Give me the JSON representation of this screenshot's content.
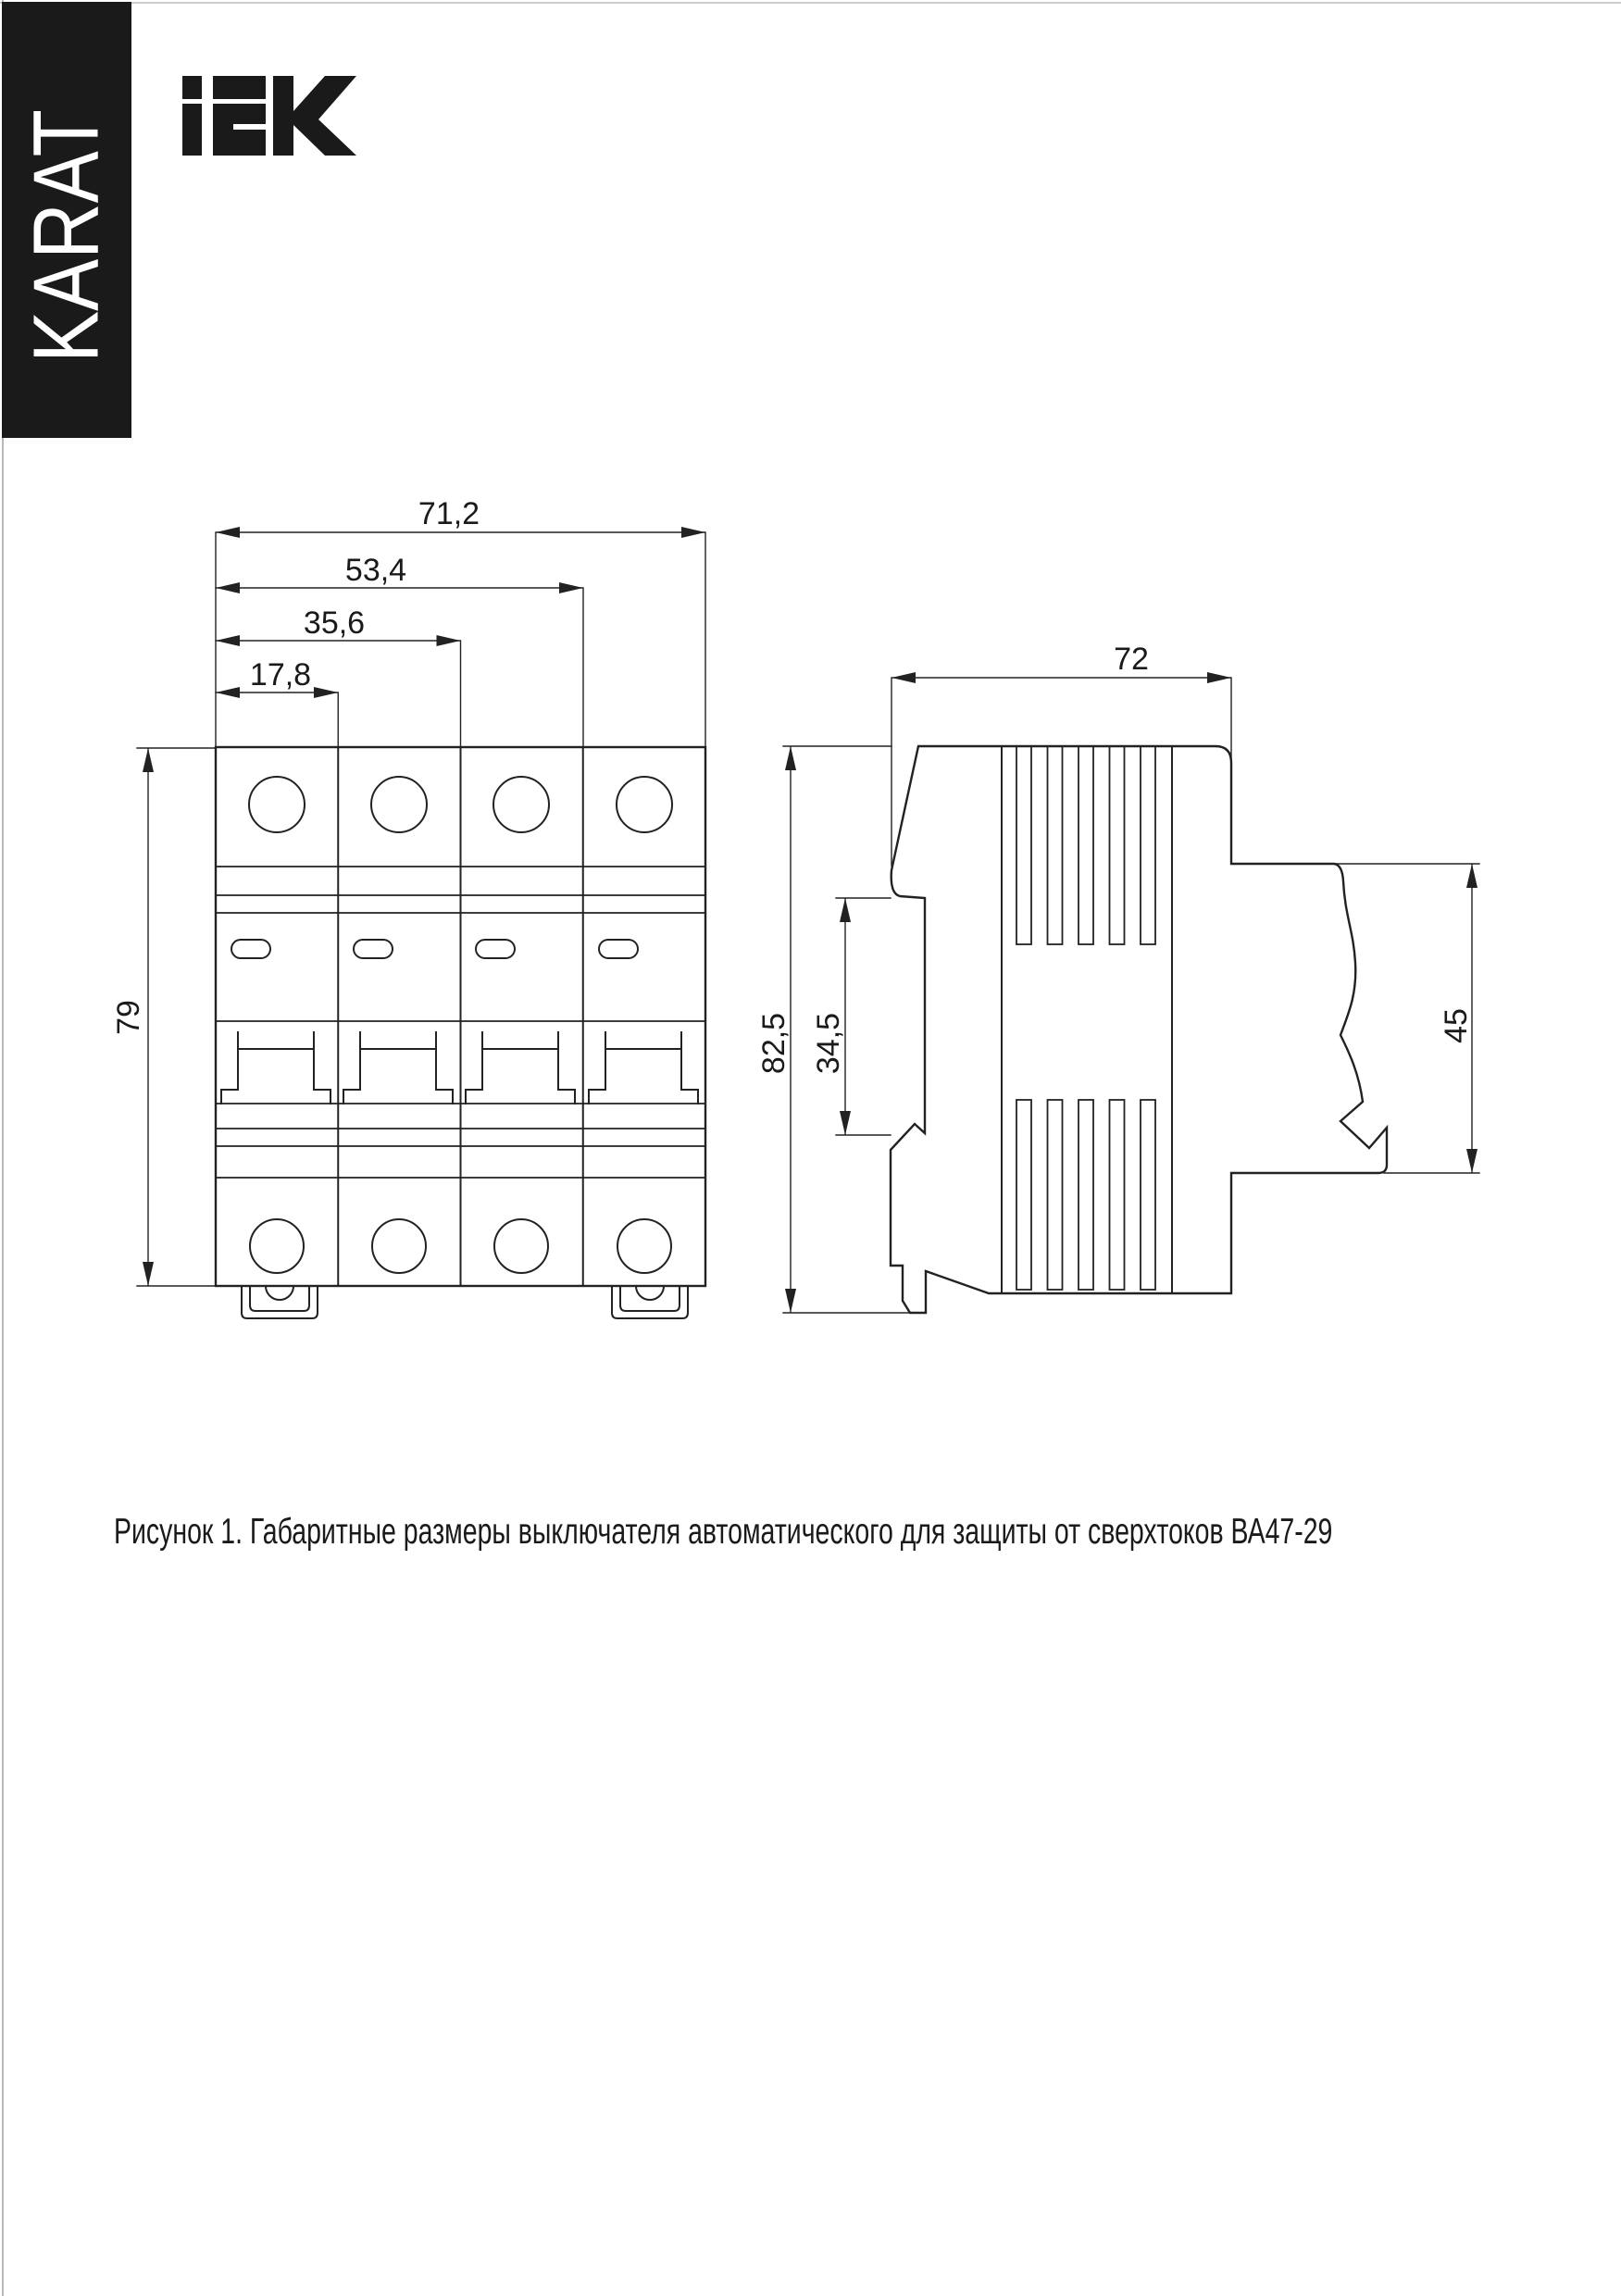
{
  "banner": {
    "text": "KARAT"
  },
  "header": {
    "logo_icon": "iek-logo"
  },
  "front_view": {
    "dimensions": {
      "total_width": "71,2",
      "width_three_modules": "53,4",
      "width_two_modules": "35,6",
      "width_one_module": "17,8",
      "height": "79"
    }
  },
  "side_view": {
    "logo_icon": "iek-logo",
    "dimensions": {
      "depth": "72",
      "total_height": "82,5",
      "din_rail_zone_height": "34,5",
      "front_part_height": "45"
    }
  },
  "caption": {
    "text": "Рисунок 1. Габаритные размеры выключателя автоматического для защиты от сверхтоков ВА47-29"
  },
  "colors": {
    "ink": "#1f1f1f",
    "banner_background": "#1a1a1a",
    "banner_text": "#ffffff",
    "page_background": "#ffffff"
  }
}
